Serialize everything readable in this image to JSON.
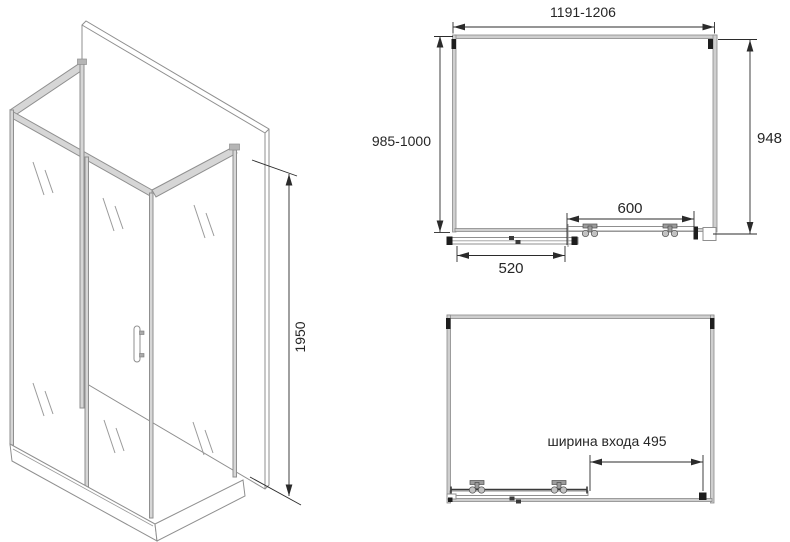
{
  "iso_view": {
    "height_dim": "1950"
  },
  "plan_closed": {
    "width_dim": "1191-1206",
    "depth_dim": "985-1000",
    "glass_width_dim": "948",
    "fixed_section_dim": "600",
    "door_section_dim": "520"
  },
  "plan_open": {
    "entrance_width_dim": "ширина входа 495"
  },
  "colors": {
    "background": "#ffffff",
    "profile_gray": "#8f8f8f",
    "profile_fill": "#d6d6d6",
    "dimension_black": "#2b2b2b",
    "cap_black": "#1d1d1d"
  }
}
